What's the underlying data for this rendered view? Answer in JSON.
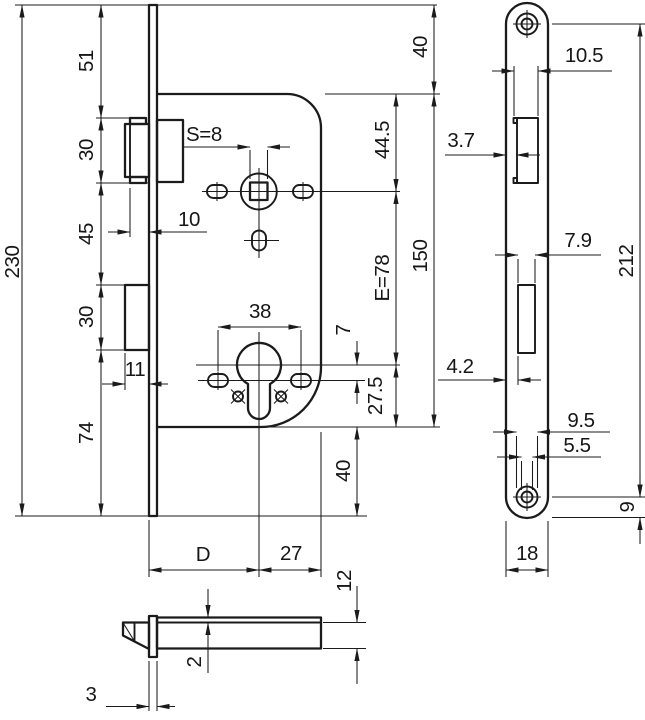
{
  "drawing": {
    "front_view": {
      "height_chain": {
        "total_height": "230",
        "top_to_latch": "51",
        "latch_height": "30",
        "latch_to_bolt": "45",
        "bolt_height": "30",
        "bolt_to_bottom": "74"
      },
      "right_chain": {
        "plate_top_to_case": "40",
        "case_to_spindle": "44.5",
        "case_height": "150",
        "spindle_to_cylinder": "E=78",
        "cylinder_to_screw": "7",
        "cylinder_to_case_bottom": "27.5",
        "case_to_plate_bottom": "40"
      },
      "detail_dims": {
        "spindle_square": "S=8",
        "latch_throw": "10",
        "bolt_throw": "11",
        "screw_spacing": "38"
      },
      "bottom_dims": {
        "backset": "D",
        "cylinder_to_case_edge": "27"
      }
    },
    "bottom_view": {
      "case_depth": "12",
      "lid_thickness": "2",
      "plate_thickness": "3"
    },
    "faceplate_view": {
      "latch_cutout_width": "10.5",
      "latch_cutout_offset": "3.7",
      "bolt_cutout_width": "7.9",
      "bolt_cutout_offset": "4.2",
      "screw_hole_spacing": "212",
      "screw_head_dia": "9.5",
      "screw_hole_dia": "5.5",
      "screw_to_plate_end": "9",
      "plate_width": "18"
    }
  }
}
